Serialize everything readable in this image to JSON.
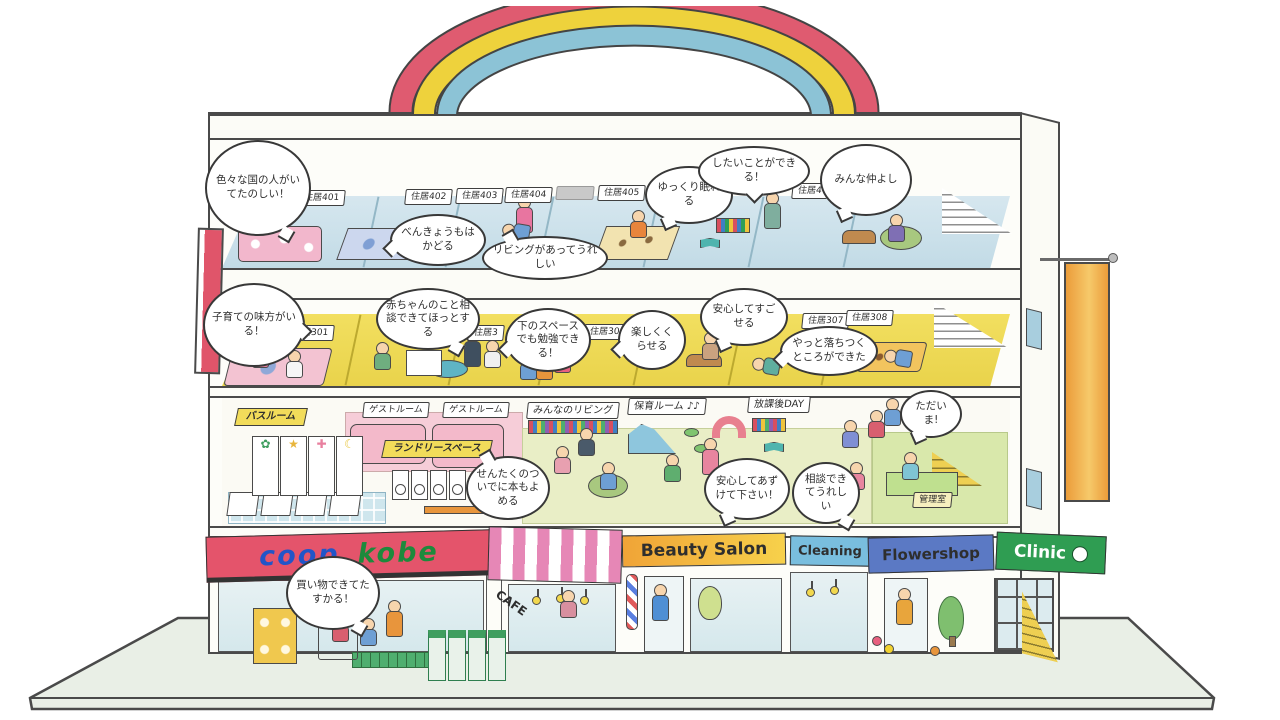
{
  "meta": {
    "title": "coop kobe building cross-section illustration"
  },
  "palette": {
    "outline": "#4a4a4a",
    "rainbow_red": "#df5b70",
    "rainbow_yellow": "#eed23c",
    "rainbow_blue": "#8cc3d6",
    "floor4_blue": "#cfe2eb",
    "floor3_yellow": "#efdd5e",
    "floor2_green": "#e9eec6",
    "awning_coop_red": "#e4546b",
    "coop_blue": "#2255c8",
    "kobe_green": "#1d8a3c",
    "awning_cafe_pink": "#e687b6",
    "sign_beauty_orange": "#f0a437",
    "sign_cleaning_blue": "#79bede",
    "sign_flower_blue": "#5b79c4",
    "sign_clinic_green": "#2f9d52",
    "banner_left_red": "#e0556a",
    "banner_right_orange": "#f0b045",
    "ground_green": "#e9efe6"
  },
  "f4": {
    "rooms": [
      "住居401",
      "住居402",
      "住居403",
      "住居404",
      "住居405",
      "住居4"
    ],
    "bubbles": {
      "countries": "色々な国の人がいてたのしい！",
      "study": "べんきょうもはかどる",
      "living": "リビングがあってうれしい",
      "sleep": "ゆっくり眠れる",
      "cando": "したいことができる！",
      "friends": "みんな仲よし"
    }
  },
  "f3": {
    "rooms": [
      "住居301",
      "住居3",
      "住居304",
      "住居307",
      "住居308"
    ],
    "bubbles": {
      "ally": "子育ての味方がいる！",
      "baby": "赤ちゃんのこと相談できてほっとする",
      "study": "下のスペースでも勉強できる！",
      "fun": "楽しくくらせる",
      "safe": "安心してすごせる",
      "calm": "やっと落ちつくところができた"
    }
  },
  "f2": {
    "areas": {
      "bathroom": "バスルーム",
      "guest1": "ゲストルーム",
      "guest2": "ゲストルーム",
      "laundry": "ランドリースペース",
      "living": "みんなのリビング",
      "nursery": "保育ルーム ♪♪",
      "afterschool": "放課後DAY",
      "office": "管理室"
    },
    "shower_symbols": [
      "✿",
      "★",
      "✚",
      "☾"
    ],
    "bubbles": {
      "laundry_read": "せんたくのついでに本もよめる",
      "entrust": "安心してあずけて下さい！",
      "consult": "相談できてうれしい",
      "tadaima": "ただいま!"
    }
  },
  "f1": {
    "shops": {
      "coop_left": "coop",
      "coop_right": "kobe",
      "cafe": "CAFE",
      "beauty": "Beauty Salon",
      "cleaning": "Cleaning",
      "flower": "Flowershop",
      "clinic": "Clinic"
    },
    "bubbles": {
      "shopping": "買い物できてたすかる！"
    }
  }
}
